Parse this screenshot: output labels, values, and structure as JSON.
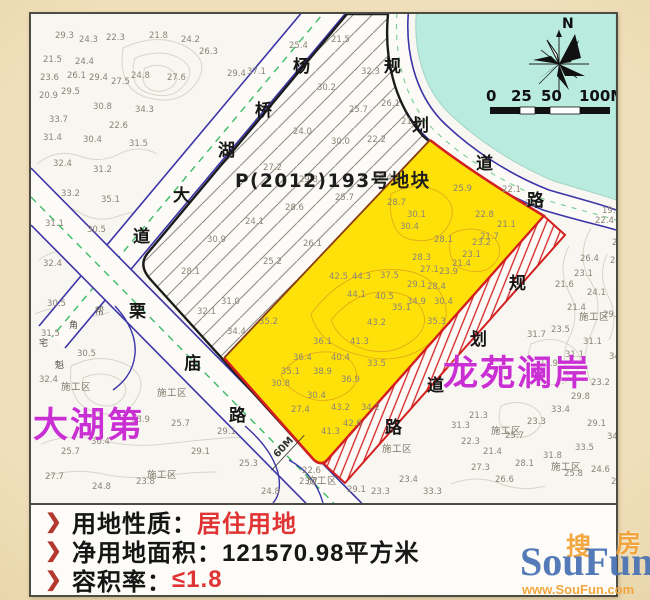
{
  "page": {
    "background": "#e9d6ae"
  },
  "map": {
    "parcel_label": "P(2012)193号地块",
    "label_left": "大湖第",
    "label_right": "龙苑澜岸",
    "compass_n": "N",
    "scale_ticks": {
      "t0": "0",
      "t25": "25",
      "t50": "50",
      "t100": "100M"
    },
    "road_width_label": "60M",
    "road_names": {
      "yangqiaohu": {
        "full": "杨桥湖大道",
        "chars": [
          "杨",
          "桥",
          "湖",
          "大",
          "道"
        ]
      },
      "limiao": {
        "full": "栗庙路",
        "chars": [
          "栗",
          "庙",
          "路"
        ]
      },
      "planned_north": {
        "full": "规划道路",
        "chars": [
          "规",
          "划",
          "道",
          "路"
        ]
      },
      "planned_south": {
        "full": "规划道路",
        "chars": [
          "规",
          "划",
          "道",
          "路"
        ]
      }
    },
    "construction_label": "施工区",
    "construction_positions": [
      [
        30,
        376
      ],
      [
        126,
        382
      ],
      [
        116,
        464
      ],
      [
        276,
        470
      ],
      [
        460,
        420
      ],
      [
        548,
        306
      ],
      [
        520,
        456
      ],
      [
        351,
        438
      ]
    ],
    "glyph_marks": [
      [
        8,
        332,
        "宅"
      ],
      [
        38,
        314,
        "角"
      ],
      [
        24,
        354,
        "魁"
      ],
      [
        64,
        300,
        "帮"
      ]
    ],
    "elevation_marks": [
      [
        24,
        24,
        "29.3"
      ],
      [
        48,
        28,
        "24.3"
      ],
      [
        75,
        26,
        "22.3"
      ],
      [
        118,
        24,
        "21.8"
      ],
      [
        150,
        28,
        "24.2"
      ],
      [
        168,
        40,
        "26.3"
      ],
      [
        12,
        48,
        "21.5"
      ],
      [
        44,
        50,
        "24.4"
      ],
      [
        9,
        66,
        "23.6"
      ],
      [
        36,
        64,
        "26.1"
      ],
      [
        58,
        66,
        "29.4"
      ],
      [
        80,
        70,
        "27.5"
      ],
      [
        8,
        84,
        "20.9"
      ],
      [
        30,
        80,
        "29.5"
      ],
      [
        100,
        64,
        "24.8"
      ],
      [
        136,
        66,
        "27.6"
      ],
      [
        62,
        95,
        "30.8"
      ],
      [
        104,
        98,
        "34.3"
      ],
      [
        18,
        108,
        "33.7"
      ],
      [
        78,
        114,
        "22.6"
      ],
      [
        12,
        126,
        "31.4"
      ],
      [
        52,
        128,
        "30.4"
      ],
      [
        98,
        132,
        "31.5"
      ],
      [
        22,
        152,
        "32.4"
      ],
      [
        62,
        158,
        "31.2"
      ],
      [
        30,
        182,
        "33.2"
      ],
      [
        70,
        188,
        "35.1"
      ],
      [
        14,
        212,
        "31.1"
      ],
      [
        56,
        218,
        "30.5"
      ],
      [
        12,
        252,
        "32.4"
      ],
      [
        16,
        292,
        "30.5"
      ],
      [
        10,
        322,
        "31.5"
      ],
      [
        46,
        342,
        "30.5"
      ],
      [
        8,
        368,
        "32.4"
      ],
      [
        196,
        62,
        "29.4"
      ],
      [
        216,
        60,
        "37.1"
      ],
      [
        258,
        34,
        "25.4"
      ],
      [
        300,
        28,
        "21.5"
      ],
      [
        330,
        60,
        "32.3"
      ],
      [
        286,
        76,
        "30.2"
      ],
      [
        318,
        98,
        "25.7"
      ],
      [
        350,
        92,
        "26.1"
      ],
      [
        262,
        120,
        "24.0"
      ],
      [
        300,
        130,
        "30.0"
      ],
      [
        336,
        128,
        "22.2"
      ],
      [
        370,
        110,
        "21.5"
      ],
      [
        232,
        156,
        "27.2"
      ],
      [
        268,
        168,
        "29.8"
      ],
      [
        304,
        186,
        "25.7"
      ],
      [
        342,
        166,
        "23.4"
      ],
      [
        176,
        228,
        "30.9"
      ],
      [
        214,
        210,
        "24.1"
      ],
      [
        254,
        196,
        "28.6"
      ],
      [
        232,
        250,
        "25.2"
      ],
      [
        272,
        232,
        "26.1"
      ],
      [
        150,
        260,
        "28.1"
      ],
      [
        190,
        290,
        "31.0"
      ],
      [
        228,
        310,
        "35.2"
      ],
      [
        166,
        300,
        "32.1"
      ],
      [
        196,
        320,
        "34.4"
      ],
      [
        471,
        178,
        "22.1"
      ],
      [
        494,
        192,
        "21.2"
      ],
      [
        444,
        203,
        "22.8"
      ],
      [
        422,
        177,
        "25.9"
      ],
      [
        466,
        213,
        "21.1"
      ],
      [
        449,
        225,
        "21.7"
      ],
      [
        356,
        191,
        "28.7"
      ],
      [
        376,
        203,
        "30.1"
      ],
      [
        369,
        215,
        "30.4"
      ],
      [
        403,
        228,
        "28.1"
      ],
      [
        441,
        231,
        "23.2"
      ],
      [
        431,
        243,
        "23.1"
      ],
      [
        421,
        252,
        "21.4"
      ],
      [
        381,
        246,
        "28.3"
      ],
      [
        389,
        258,
        "27.1"
      ],
      [
        408,
        260,
        "23.9"
      ],
      [
        298,
        265,
        "42.5"
      ],
      [
        321,
        265,
        "44.3"
      ],
      [
        349,
        264,
        "37.5"
      ],
      [
        376,
        273,
        "29.1"
      ],
      [
        396,
        275,
        "28.4"
      ],
      [
        316,
        283,
        "44.1"
      ],
      [
        344,
        285,
        "40.5"
      ],
      [
        376,
        290,
        "34.9"
      ],
      [
        403,
        290,
        "30.4"
      ],
      [
        361,
        296,
        "35.1"
      ],
      [
        336,
        311,
        "43.2"
      ],
      [
        396,
        310,
        "35.3"
      ],
      [
        319,
        330,
        "41.3"
      ],
      [
        300,
        346,
        "40.4"
      ],
      [
        282,
        330,
        "36.1"
      ],
      [
        262,
        346,
        "36.4"
      ],
      [
        250,
        360,
        "35.1"
      ],
      [
        282,
        360,
        "38.9"
      ],
      [
        310,
        368,
        "36.9"
      ],
      [
        336,
        352,
        "33.5"
      ],
      [
        276,
        384,
        "30.4"
      ],
      [
        300,
        396,
        "43.2"
      ],
      [
        260,
        398,
        "27.4"
      ],
      [
        312,
        412,
        "42.6"
      ],
      [
        330,
        396,
        "34.2"
      ],
      [
        290,
        420,
        "41.3"
      ],
      [
        240,
        372,
        "30.8"
      ],
      [
        571,
        199,
        "19.3"
      ],
      [
        564,
        209,
        "22.4"
      ],
      [
        581,
        231,
        "22.1"
      ],
      [
        549,
        247,
        "26.4"
      ],
      [
        579,
        249,
        "24.8"
      ],
      [
        543,
        262,
        "23.1"
      ],
      [
        524,
        273,
        "21.6"
      ],
      [
        556,
        281,
        "24.1"
      ],
      [
        536,
        296,
        "21.4"
      ],
      [
        572,
        303,
        "29.1"
      ],
      [
        520,
        318,
        "23.5"
      ],
      [
        552,
        330,
        "31.1"
      ],
      [
        578,
        345,
        "34.1"
      ],
      [
        534,
        343,
        "31.1"
      ],
      [
        508,
        352,
        "23.9"
      ],
      [
        496,
        323,
        "31.7"
      ],
      [
        560,
        371,
        "23.2"
      ],
      [
        540,
        385,
        "29.8"
      ],
      [
        520,
        398,
        "33.4"
      ],
      [
        496,
        410,
        "23.3"
      ],
      [
        474,
        424,
        "25.7"
      ],
      [
        556,
        412,
        "29.1"
      ],
      [
        576,
        425,
        "34.6"
      ],
      [
        544,
        436,
        "33.5"
      ],
      [
        512,
        444,
        "31.8"
      ],
      [
        484,
        452,
        "28.1"
      ],
      [
        452,
        440,
        "21.4"
      ],
      [
        440,
        456,
        "27.3"
      ],
      [
        464,
        468,
        "26.6"
      ],
      [
        533,
        462,
        "25.8"
      ],
      [
        560,
        458,
        "24.6"
      ],
      [
        580,
        470,
        "28.7"
      ],
      [
        430,
        430,
        "22.3"
      ],
      [
        420,
        414,
        "31.3"
      ],
      [
        438,
        404,
        "21.3"
      ],
      [
        14,
        465,
        "27.7"
      ],
      [
        61,
        475,
        "24.8"
      ],
      [
        105,
        470,
        "23.8"
      ],
      [
        271,
        459,
        "22.6"
      ],
      [
        268,
        470,
        "23.7"
      ],
      [
        208,
        452,
        "25.3"
      ],
      [
        160,
        440,
        "29.1"
      ],
      [
        60,
        430,
        "36.4"
      ],
      [
        30,
        440,
        "25.7"
      ],
      [
        100,
        408,
        "28.9"
      ],
      [
        140,
        412,
        "25.7"
      ],
      [
        186,
        420,
        "29.1"
      ],
      [
        230,
        480,
        "24.8"
      ],
      [
        316,
        478,
        "29.1"
      ],
      [
        340,
        480,
        "23.3"
      ],
      [
        368,
        468,
        "23.4"
      ],
      [
        392,
        480,
        "33.3"
      ]
    ]
  },
  "info": {
    "bullet": "❯",
    "rows": [
      {
        "label": "用地性质：",
        "value": "居住用地",
        "highlight": true
      },
      {
        "label": "净用地面积：",
        "value": "121570.98平方米",
        "highlight": false
      },
      {
        "label": "容积率：",
        "value": "≤1.8",
        "highlight": true
      }
    ]
  },
  "watermark": {
    "cn_left": "搜",
    "cn_right": "房",
    "name": "SouFun",
    "url": "www.SouFun.com"
  },
  "colors": {
    "parcel_yellow": "#ffe10a",
    "boundary_red": "#d31f1f",
    "road_blue": "#3b35a8",
    "centerline_green": "#3dbb66",
    "label_magenta": "#c92fd2",
    "info_value_red": "#e03434",
    "water": "#b9ecdf"
  }
}
